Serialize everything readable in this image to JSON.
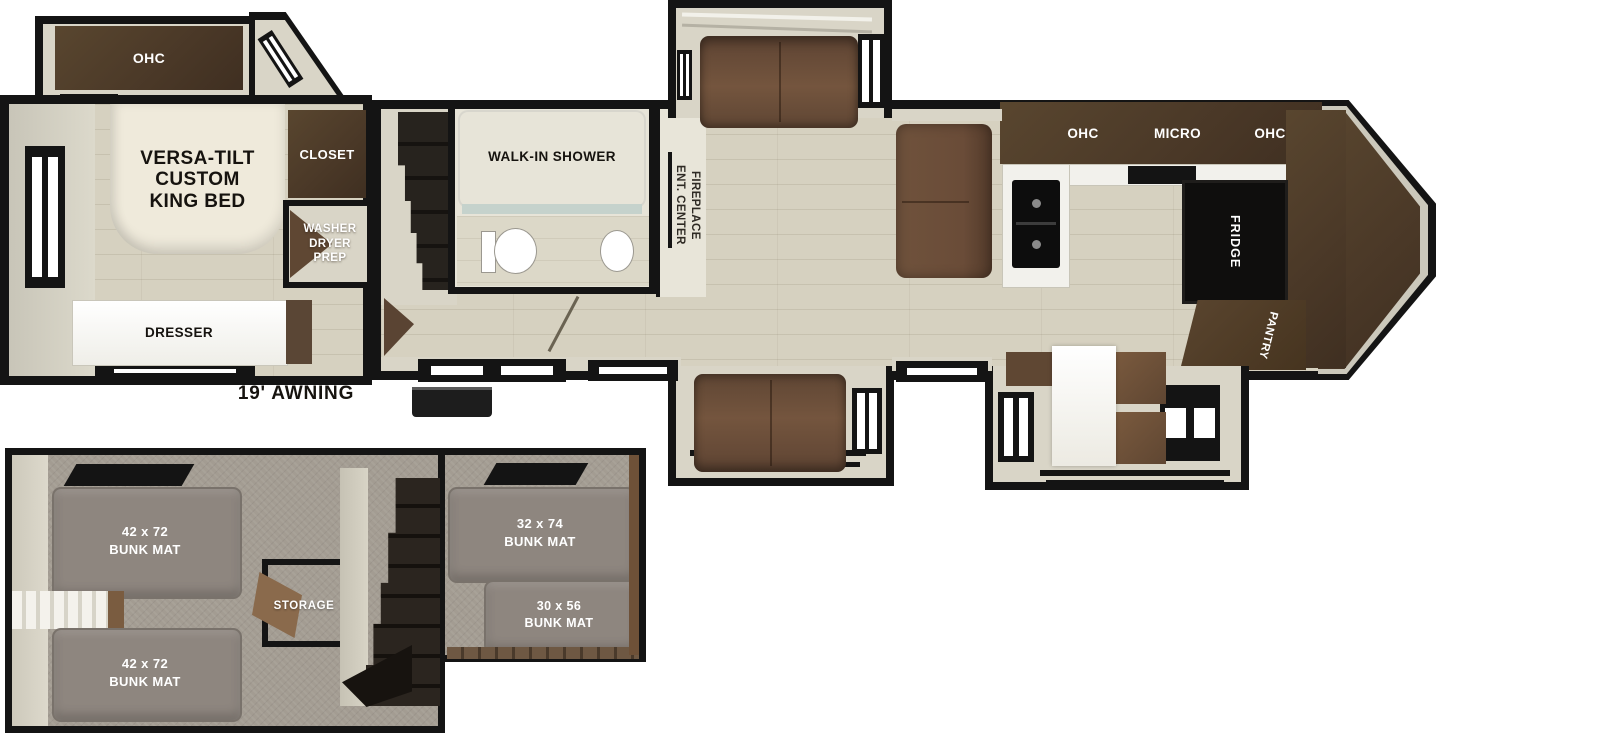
{
  "main": {
    "awning_label": "19' AWNING",
    "bedroom": {
      "ohc_label": "OHC",
      "bed_label": "VERSA-TILT\nCUSTOM\nKING BED",
      "closet_label": "CLOSET",
      "washer_dryer_label": "WASHER\nDRYER\nPREP",
      "dresser_label": "DRESSER"
    },
    "bathroom": {
      "shower_label": "WALK-IN SHOWER"
    },
    "living": {
      "ent_center_label": "ENT. CENTER\nFIREPLACE"
    },
    "kitchen": {
      "ohc_left_label": "OHC",
      "micro_label": "MICRO",
      "ohc_right_label": "OHC",
      "fridge_label": "FRIDGE",
      "pantry_label": "PANTRY"
    }
  },
  "bunkroom": {
    "mat_top_left_label": "42 x 72\nBUNK MAT",
    "mat_bottom_left_label": "42 x 72\nBUNK MAT",
    "mat_top_right_label": "32 x 74\nBUNK MAT",
    "mat_bottom_right_label": "30 x 56\nBUNK MAT",
    "storage_label": "STORAGE"
  },
  "colors": {
    "wall": "#141414",
    "wood_floor": "#d6d1c0",
    "beige_wall": "#d9d5c7",
    "cabinet_brown": "#4e3c2d",
    "sofa_brown": "#6a4c38",
    "carpet_gray": "#a39c92",
    "bunk_mat_gray": "#8e867f",
    "bed_cream": "#efeadb"
  }
}
